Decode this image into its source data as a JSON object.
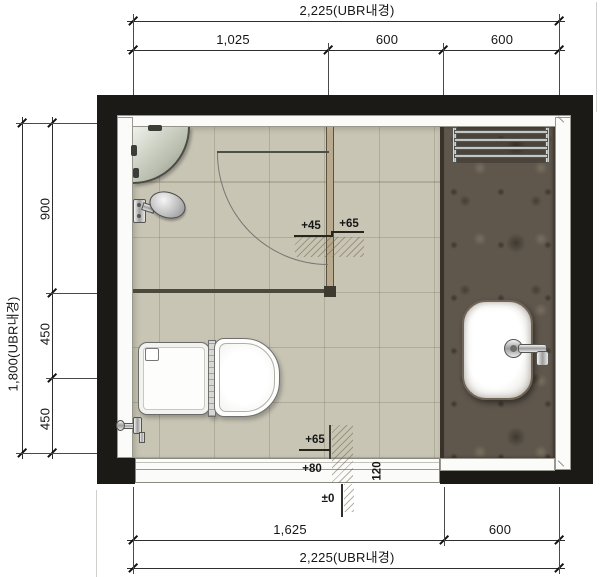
{
  "plan": {
    "unit_note": "UBR내경",
    "dims_top": {
      "overall": "2,225(UBR내경)",
      "seg1": "1,025",
      "seg2": "600",
      "seg3": "600"
    },
    "dims_left": {
      "overall": "1,800(UBR내경)",
      "seg1": "900",
      "seg2": "450",
      "seg3": "450"
    },
    "dims_bottom": {
      "seg1": "1,625",
      "seg2": "600",
      "overall": "2,225(UBR내경)"
    },
    "levels": {
      "shower_step": "+45",
      "door_floor": "+65",
      "entry_floor": "+65",
      "threshold": "+80",
      "threshold_depth": "120",
      "outside_datum": "±0"
    },
    "fixtures": {
      "toilet": "toilet",
      "washbasin": "washbasin",
      "shower_head": "shower-head",
      "corner_shelf": "corner-shelf",
      "towel_rack": "towel-rack",
      "door": "door-swing"
    },
    "colors": {
      "wall": "#1b1a17",
      "tile_floor": "#c8c5b5",
      "marble_counter": "#5f574c",
      "door_frame": "#b9aa8e"
    }
  }
}
